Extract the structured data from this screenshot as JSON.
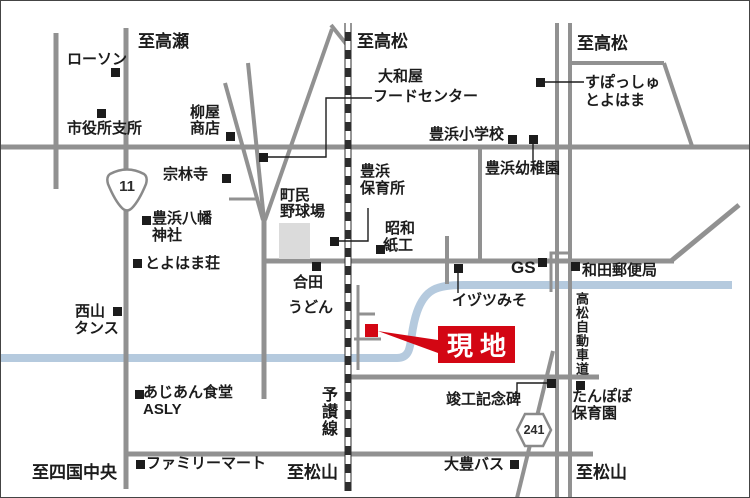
{
  "map": {
    "colors": {
      "road": "#919191",
      "river": "#b5cade",
      "rail": "#2e2e2e",
      "red": "#d30613",
      "field": "#dbdbdb",
      "ink": "#1c1c1c"
    },
    "labels": {
      "to_takase": "至高瀬",
      "to_takamatsu_center": "至高松",
      "to_takamatsu_right": "至高松",
      "to_shikokuchuo": "至四国中央",
      "to_matsuyama_center": "至松山",
      "to_matsuyama_right": "至松山",
      "lawson": "ローソン",
      "city_branch": "市役所支所",
      "yanagiya_1": "柳屋",
      "yanagiya_2": "商店",
      "sorinji": "宗林寺",
      "yamatoya_1": "大和屋",
      "yamatoya_2": "フードセンター",
      "elementary": "豊浜小学校",
      "sposh_1": "すぽっしゅ",
      "sposh_2": "とよはま",
      "kindergarten": "豊浜幼稚園",
      "hachiman_1": "豊浜八幡",
      "hachiman_2": "神社",
      "toyohamaso": "とよはま荘",
      "nursery_1": "豊浜",
      "nursery_2": "保育所",
      "ballpark_1": "町民",
      "ballpark_2": "野球場",
      "showa_1": "昭和",
      "showa_2": "紙工",
      "goda_1": "合田",
      "goda_2": "うどん",
      "gs": "GS",
      "wada_post_office": "和田郵便局",
      "nishiyama_1": "西山",
      "nishiyama_2": "タンス",
      "izutsu": "イヅツみそ",
      "asian_1": "あじあん食堂",
      "asian_2": "ASLY",
      "familymart": "ファミリーマート",
      "tanpopo_1": "たんぽぽ",
      "tanpopo_2": "保育園",
      "monument": "竣工記念碑",
      "daitoyo_bus": "大豊バス",
      "yosan_line": "予讃線",
      "expressway": "高松自動車道",
      "site": "現地",
      "route11": "11",
      "route241": "241"
    }
  }
}
